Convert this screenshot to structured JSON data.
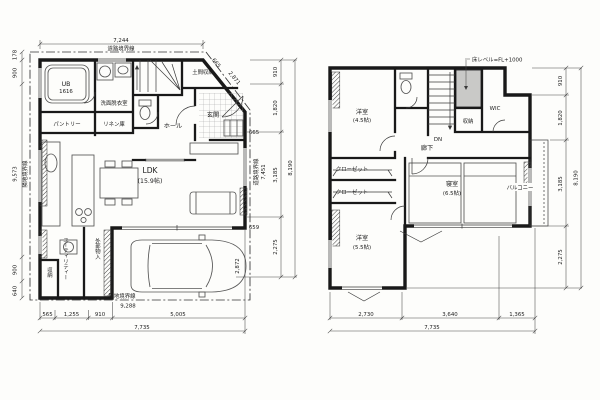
{
  "colors": {
    "ink": "#1c1c1c",
    "dim_text": "#3c3c3c",
    "gray_fill": "#c9c9c7",
    "background": "#fdfdfb"
  },
  "plan1": {
    "top": {
      "dim_7244": "7,244",
      "road_boundary": "道路境界線"
    },
    "left": {
      "dim_178": "178",
      "dim_900_top": "900",
      "dim_9573": "9,573",
      "site_boundary": "隣地境界線",
      "dim_900_bottom": "900",
      "dim_640": "640"
    },
    "right": {
      "dim_665_diag": "665",
      "dim_2871": "2,871",
      "dim_910": "910",
      "dim_1820": "1,820",
      "dim_665": "665",
      "road_boundary": "道路境界線",
      "dim_7451": "7,451",
      "dim_3185": "3,185",
      "dim_659": "659",
      "dim_2275": "2,275",
      "dim_8190": "8,190",
      "dim_2872": "2,872"
    },
    "bottom": {
      "site_boundary": "隣地境界線",
      "dim_9288": "9,288",
      "dim_565": "565",
      "dim_1255": "1,255",
      "dim_910": "910",
      "dim_5005": "5,005",
      "dim_7735": "7,735"
    },
    "rooms": {
      "ub": "UB",
      "ub_size": "1616",
      "washroom": "洗面脱衣室",
      "pantry": "パントリー",
      "linen": "リネン庫",
      "doma_storage": "土間収納",
      "entrance": "玄関",
      "hall": "ホール",
      "ldk": "LDK",
      "ldk_size": "(15.9帖)",
      "utility": "ユーティリティー",
      "storage": "収納",
      "exterior_storage": "外部物入"
    }
  },
  "plan2": {
    "annotation": {
      "floor_level": "床レベル=FL+1000"
    },
    "rooms": {
      "bedroom1": "洋室",
      "bedroom1_size": "(4.5帖)",
      "wic": "WIC",
      "storage": "収納",
      "dn": "DN",
      "corridor": "廊下",
      "closet1": "クローゼット",
      "closet2": "クローゼット",
      "master": "寝室",
      "master_size": "(6.5帖)",
      "balcony": "バルコニー",
      "bedroom2": "洋室",
      "bedroom2_size": "(5.5帖)"
    },
    "right": {
      "dim_910": "910",
      "dim_1820": "1,820",
      "dim_3185": "3,185",
      "dim_2275": "2,275",
      "dim_8190": "8,190"
    },
    "bottom": {
      "dim_2730": "2,730",
      "dim_3640": "3,640",
      "dim_1365": "1,365",
      "dim_7735": "7,735"
    }
  }
}
